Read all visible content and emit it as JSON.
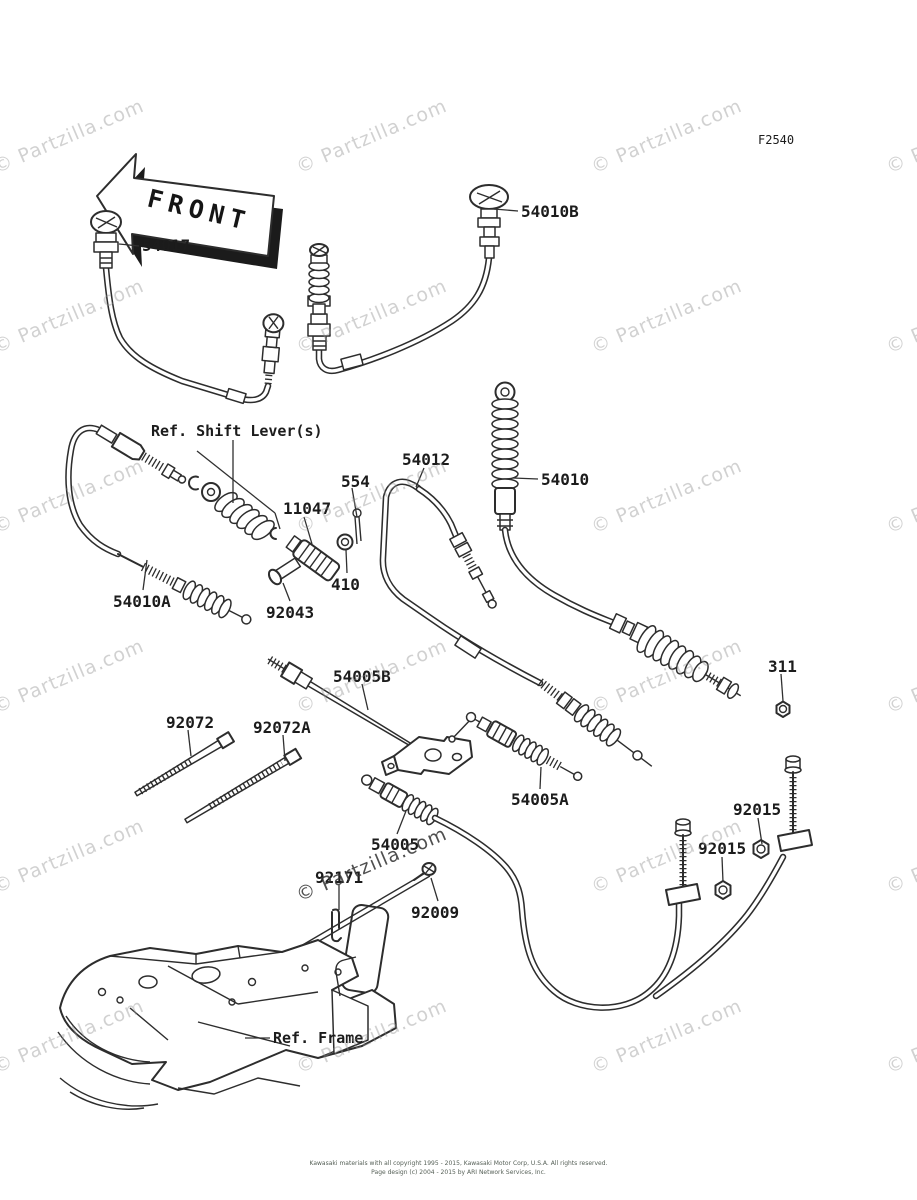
{
  "figure_code": "F2540",
  "front_marker": "FRONT",
  "watermark": {
    "text": "© Partzilla.com",
    "light_color": "rgba(145,145,145,0.42)",
    "dark_color": "rgba(55,55,55,0.88)",
    "positions": [
      {
        "x": -10,
        "y": 158
      },
      {
        "x": 293,
        "y": 158
      },
      {
        "x": 588,
        "y": 158
      },
      {
        "x": 883,
        "y": 158
      },
      {
        "x": -10,
        "y": 338
      },
      {
        "x": 293,
        "y": 338
      },
      {
        "x": 588,
        "y": 338
      },
      {
        "x": 883,
        "y": 338
      },
      {
        "x": -10,
        "y": 518
      },
      {
        "x": 293,
        "y": 518
      },
      {
        "x": 588,
        "y": 518
      },
      {
        "x": 883,
        "y": 518
      },
      {
        "x": -10,
        "y": 698
      },
      {
        "x": 293,
        "y": 698
      },
      {
        "x": 588,
        "y": 698
      },
      {
        "x": 883,
        "y": 698
      },
      {
        "x": -10,
        "y": 878
      },
      {
        "x": 293,
        "y": 886,
        "dark": true
      },
      {
        "x": 588,
        "y": 878
      },
      {
        "x": 883,
        "y": 878
      },
      {
        "x": -10,
        "y": 1058
      },
      {
        "x": 293,
        "y": 1058
      },
      {
        "x": 588,
        "y": 1058
      },
      {
        "x": 883,
        "y": 1058
      }
    ]
  },
  "footer": {
    "line1": "Kawasaki materials with all copyright 1995 - 2015, Kawasaki Motor Corp, U.S.A.  All rights reserved.",
    "line2": "Page design (c) 2004 - 2015 by ARI Network Services, Inc."
  },
  "labels": [
    {
      "id": "figure-code",
      "text": "F2540",
      "x": 758,
      "y": 133,
      "size": 12,
      "weight": "normal"
    },
    {
      "id": "54017",
      "text": "54017",
      "x": 142,
      "y": 236,
      "leader": [
        [
          139,
          246,
          119,
          244
        ]
      ]
    },
    {
      "id": "54010b",
      "text": "54010B",
      "x": 521,
      "y": 202,
      "leader": [
        [
          518,
          211,
          494,
          209
        ]
      ]
    },
    {
      "id": "ref-shift-lever",
      "text": "Ref. Shift Lever(s)",
      "x": 151,
      "y": 422,
      "size": 15,
      "leader": [
        [
          197,
          451,
          275,
          513
        ],
        [
          233,
          440,
          233,
          503
        ],
        [
          275,
          513,
          280,
          529
        ]
      ]
    },
    {
      "id": "554",
      "text": "554",
      "x": 341,
      "y": 472,
      "leader": [
        [
          352,
          488,
          357,
          517
        ]
      ]
    },
    {
      "id": "11047",
      "text": "11047",
      "x": 283,
      "y": 499,
      "leader": [
        [
          304,
          517,
          312,
          544
        ]
      ]
    },
    {
      "id": "410",
      "text": "410",
      "x": 331,
      "y": 575,
      "leader": [
        [
          347,
          573,
          346,
          550
        ]
      ]
    },
    {
      "id": "92043",
      "text": "92043",
      "x": 266,
      "y": 603,
      "leader": [
        [
          290,
          601,
          283,
          583
        ]
      ]
    },
    {
      "id": "54010a",
      "text": "54010A",
      "x": 113,
      "y": 592,
      "leader": [
        [
          143,
          590,
          147,
          560
        ]
      ]
    },
    {
      "id": "54012",
      "text": "54012",
      "x": 402,
      "y": 450,
      "leader": [
        [
          424,
          468,
          416,
          487
        ]
      ]
    },
    {
      "id": "54010",
      "text": "54010",
      "x": 541,
      "y": 470,
      "leader": [
        [
          538,
          479,
          513,
          478
        ]
      ]
    },
    {
      "id": "311",
      "text": "311",
      "x": 768,
      "y": 657,
      "leader": [
        [
          781,
          674,
          783,
          701
        ]
      ]
    },
    {
      "id": "54005b",
      "text": "54005B",
      "x": 333,
      "y": 667,
      "leader": [
        [
          362,
          684,
          368,
          710
        ]
      ]
    },
    {
      "id": "92072",
      "text": "92072",
      "x": 166,
      "y": 713,
      "leader": [
        [
          188,
          730,
          191,
          756
        ]
      ]
    },
    {
      "id": "92072a",
      "text": "92072A",
      "x": 253,
      "y": 718,
      "leader": [
        [
          283,
          735,
          285,
          761
        ]
      ]
    },
    {
      "id": "54005a",
      "text": "54005A",
      "x": 511,
      "y": 790,
      "leader": [
        [
          540,
          789,
          541,
          767
        ]
      ]
    },
    {
      "id": "54005",
      "text": "54005",
      "x": 371,
      "y": 835,
      "leader": [
        [
          397,
          834,
          406,
          811
        ]
      ]
    },
    {
      "id": "92171",
      "text": "92171",
      "x": 315,
      "y": 868,
      "leader": [
        [
          339,
          885,
          339,
          910
        ]
      ]
    },
    {
      "id": "92009",
      "text": "92009",
      "x": 411,
      "y": 903,
      "leader": [
        [
          438,
          901,
          431,
          878
        ]
      ]
    },
    {
      "id": "92015-right",
      "text": "92015",
      "x": 733,
      "y": 800,
      "leader": [
        [
          758,
          818,
          762,
          844
        ]
      ]
    },
    {
      "id": "92015-left",
      "text": "92015",
      "x": 698,
      "y": 839,
      "leader": [
        [
          722,
          857,
          723,
          882
        ]
      ]
    },
    {
      "id": "ref-frame",
      "text": "Ref. Frame",
      "x": 273,
      "y": 1029,
      "size": 15,
      "leader": [
        [
          270,
          1038,
          245,
          1038
        ]
      ]
    }
  ]
}
